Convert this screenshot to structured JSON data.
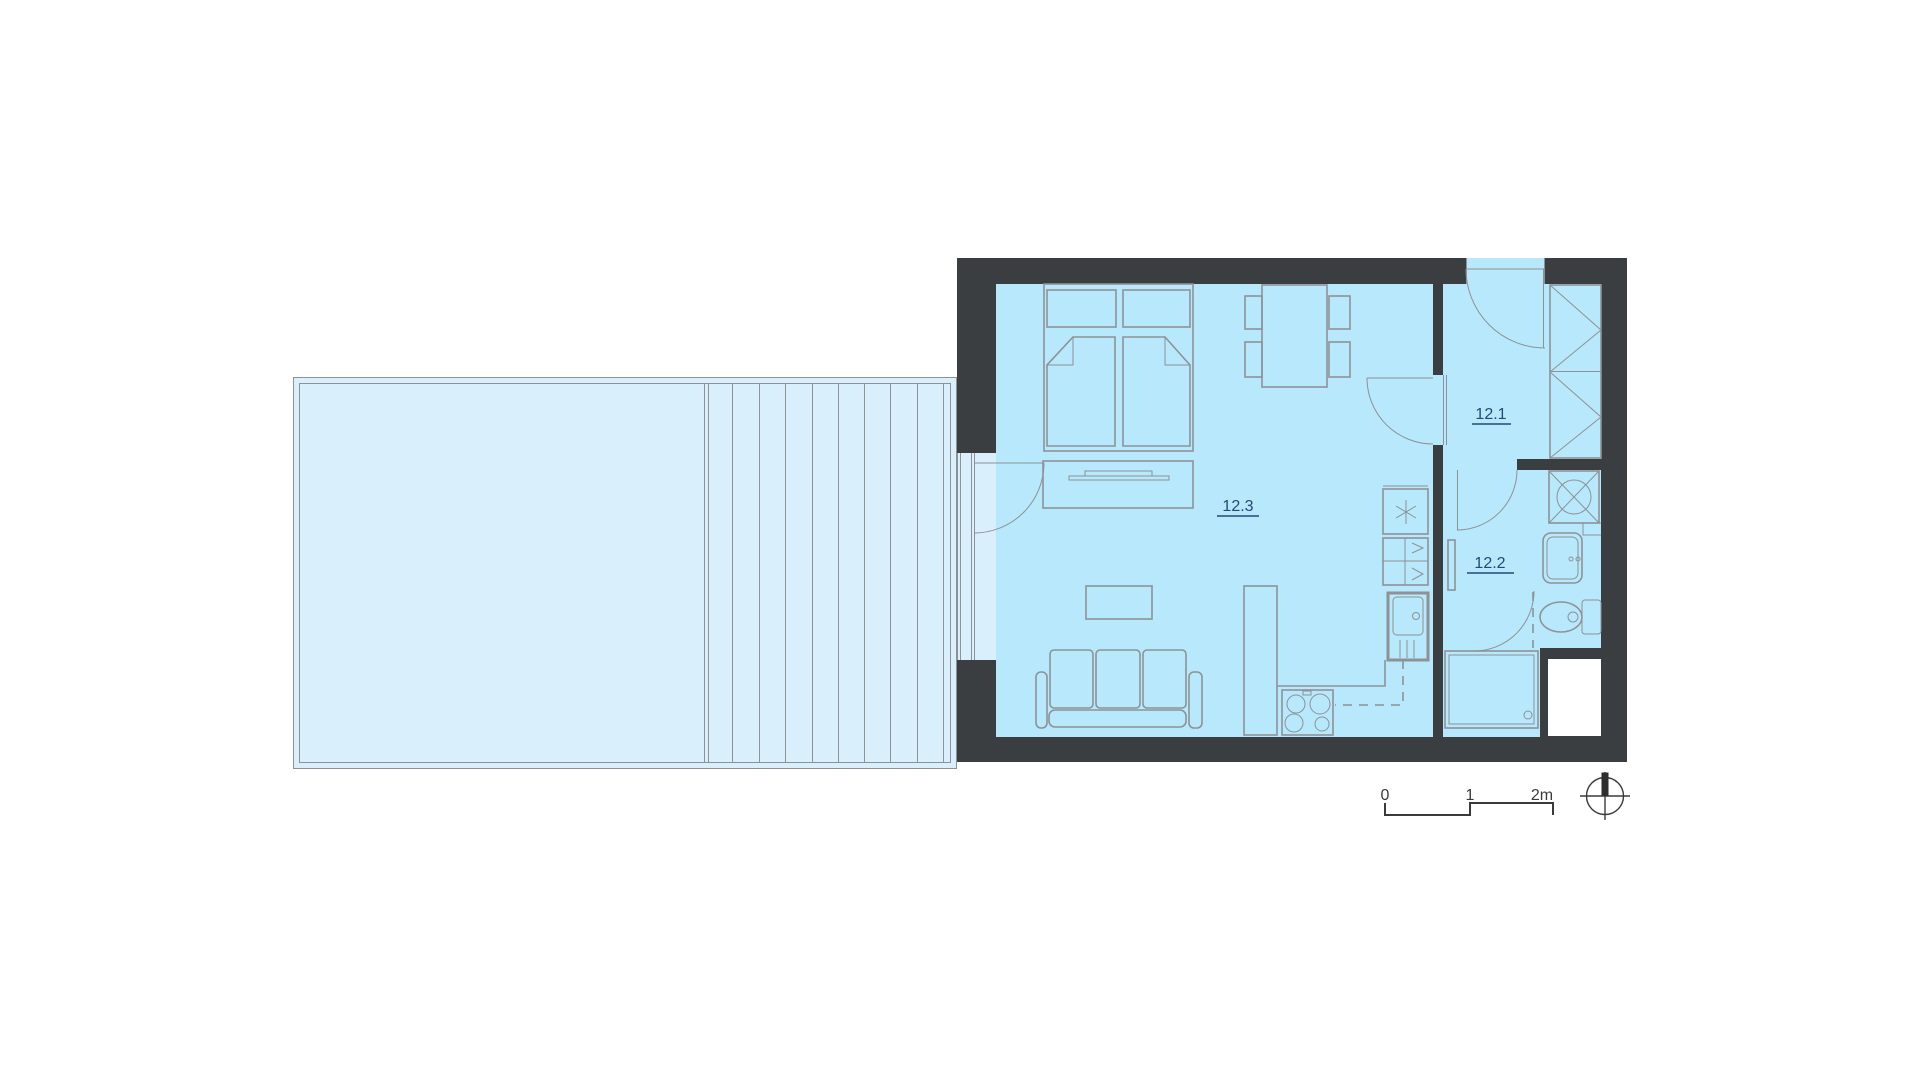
{
  "rooms": [
    {
      "label": "12.1"
    },
    {
      "label": "12.2"
    },
    {
      "label": "12.3"
    }
  ],
  "scale_bar": {
    "ticks": [
      "0",
      "1",
      "2m"
    ]
  },
  "colors": {
    "wall": "#3a3e41",
    "floor": "#b7e8fb",
    "terrace": "#d9effc",
    "line": "#8e9296",
    "label": "#27477c",
    "scale": "#3a3a3a",
    "bg": "#ffffff"
  }
}
